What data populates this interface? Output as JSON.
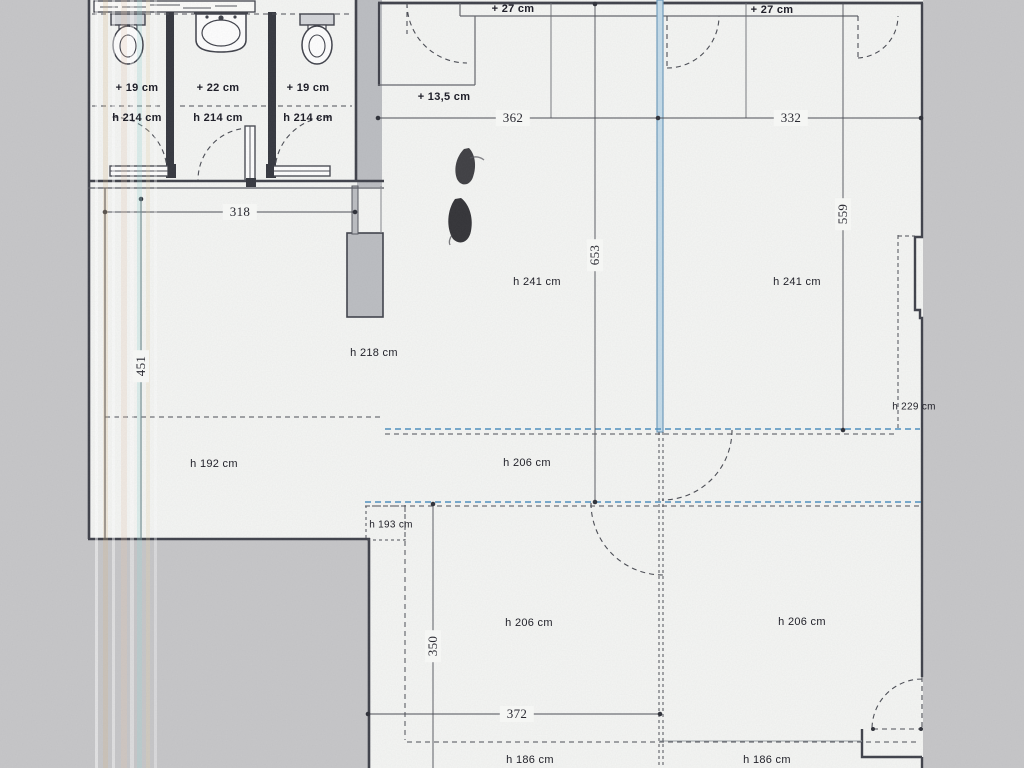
{
  "colors": {
    "paper": "#f5f6f4",
    "scan_background": "#c7c7c9",
    "wall_fill": "#bcbec2",
    "line": "#3f414a",
    "blue_wall": "#c5dcea",
    "blue_dash": "#4d8fc0"
  },
  "bathrooms": {
    "stalls": [
      {
        "icon": "toilet-icon",
        "offset": "+ 19 cm",
        "height": "h 214 cm"
      },
      {
        "icon": "sink-icon",
        "offset": "+ 22 cm",
        "height": "h 214 cm"
      },
      {
        "icon": "toilet-icon",
        "offset": "+ 19 cm",
        "height": "h 214 cm"
      }
    ]
  },
  "annotations": {
    "plus27_left": "+ 27 cm",
    "plus27_right": "+ 27 cm",
    "plus135": "+ 13,5 cm"
  },
  "dimensions": {
    "w318": "318",
    "w362": "362",
    "w332": "332",
    "w372": "372",
    "v653": "653",
    "v559": "559",
    "v451": "451",
    "v350": "350"
  },
  "heights": {
    "h241_left": "h 241 cm",
    "h241_right": "h 241 cm",
    "h218": "h 218 cm",
    "h192": "h 192 cm",
    "h206_mid": "h 206 cm",
    "h206_bottom_left": "h 206 cm",
    "h206_bottom_right": "h 206 cm",
    "h193": "h 193 cm",
    "h229": "h 229 cm",
    "h186_left": "h 186 cm",
    "h186_right": "h 186 cm"
  }
}
